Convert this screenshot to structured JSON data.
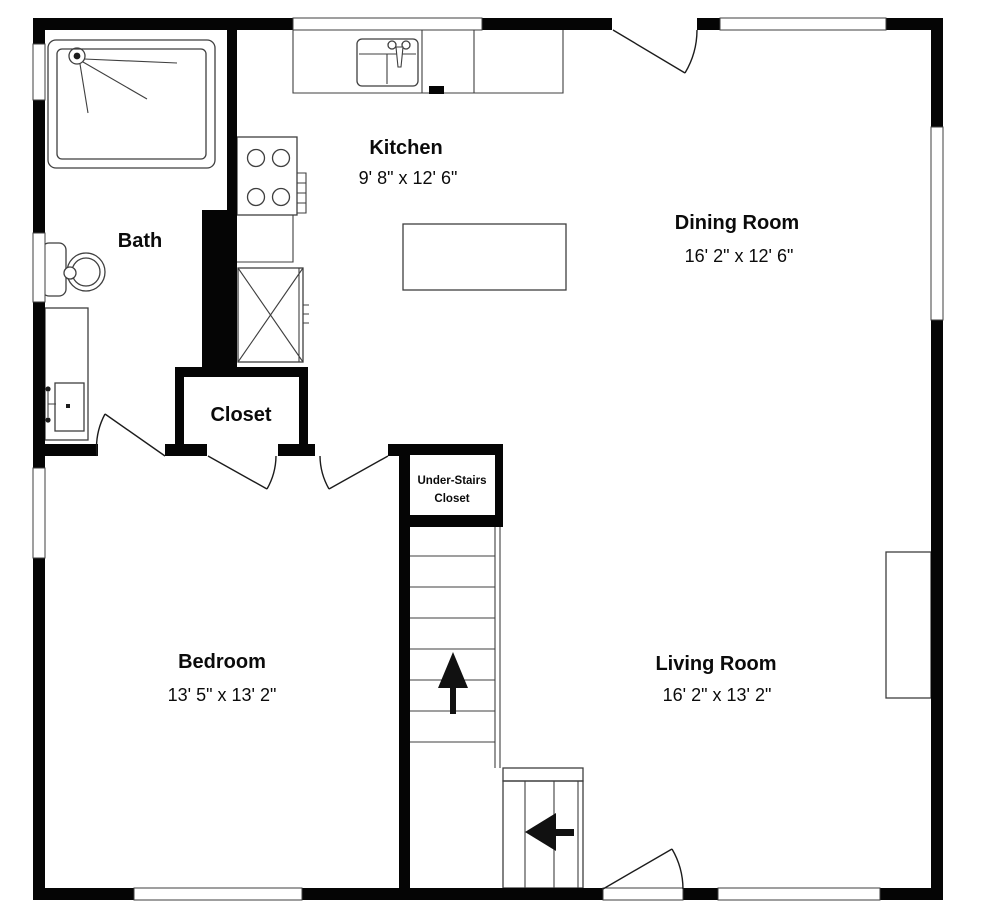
{
  "title": "First floor plan",
  "colors": {
    "wall": "#050505",
    "line": "#3f3f3f",
    "bg": "#ffffff"
  },
  "rooms": {
    "kitchen": {
      "label": "Kitchen",
      "dims": "9' 8\" x 12' 6\""
    },
    "dining": {
      "label": "Dining Room",
      "dims": "16' 2\" x 12' 6\""
    },
    "bath": {
      "label": "Bath"
    },
    "closet": {
      "label": "Closet"
    },
    "under_stairs": {
      "line1": "Under-Stairs",
      "line2": "Closet"
    },
    "bedroom": {
      "label": "Bedroom",
      "dims": "13' 5\" x 13' 2\""
    },
    "living": {
      "label": "Living Room",
      "dims": "16' 2\" x 13' 2\""
    }
  }
}
